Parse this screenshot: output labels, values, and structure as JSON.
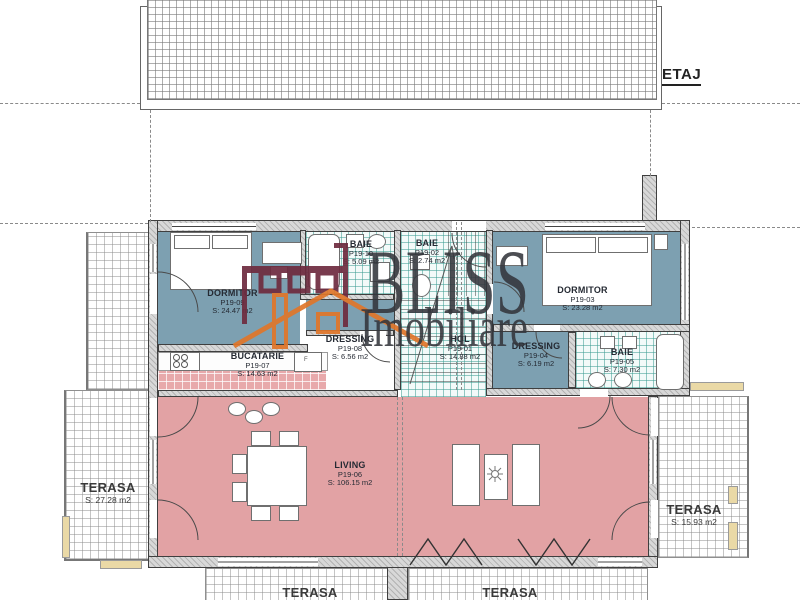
{
  "plan": {
    "floor_label": "ETAJ",
    "rooms": [
      {
        "name": "DORMITOR",
        "code": "P19-09",
        "area": "S: 24.47 m2"
      },
      {
        "name": "BAIE",
        "code": "P19-10",
        "area": "S: 5.09 m2"
      },
      {
        "name": "BUCATARIE",
        "code": "P19-07",
        "area": "S: 14.63 m2"
      },
      {
        "name": "DRESSING",
        "code": "P19-08",
        "area": "S: 6.56 m2"
      },
      {
        "name": "BAIE",
        "code": "P19-02",
        "area": "S: 2.74 m2"
      },
      {
        "name": "HOL",
        "code": "P19-01",
        "area": "S: 14.88 m2"
      },
      {
        "name": "DORMITOR",
        "code": "P19-03",
        "area": "S: 23.28 m2"
      },
      {
        "name": "DRESSING",
        "code": "P19-04",
        "area": "S: 6.19 m2"
      },
      {
        "name": "BAIE",
        "code": "P19-05",
        "area": "S: 7.30 m2"
      },
      {
        "name": "LIVING",
        "code": "P19-06",
        "area": "S: 106.15 m2"
      }
    ],
    "terraces": [
      {
        "name": "TERASA",
        "area": "S: 27.28 m2"
      },
      {
        "name": "TERASA",
        "area": "S: 15.93 m2"
      },
      {
        "name": "TERASA",
        "area": ""
      },
      {
        "name": "TERASA",
        "area": ""
      }
    ],
    "fridge_label": "F"
  },
  "watermark": {
    "line1": "BLISS",
    "line2": "Imobiliare"
  },
  "colors": {
    "bedroom_fill": "#7da0b1",
    "living_fill": "#e2a2a4",
    "kitchen_tile": "#e8a9ab",
    "bath_hatch": "#409e94",
    "wall_fill": "#d8d8d8",
    "watermark_text": "#34363c",
    "logo_maroon": "#6e2b3f",
    "logo_orange": "#e0762a"
  }
}
